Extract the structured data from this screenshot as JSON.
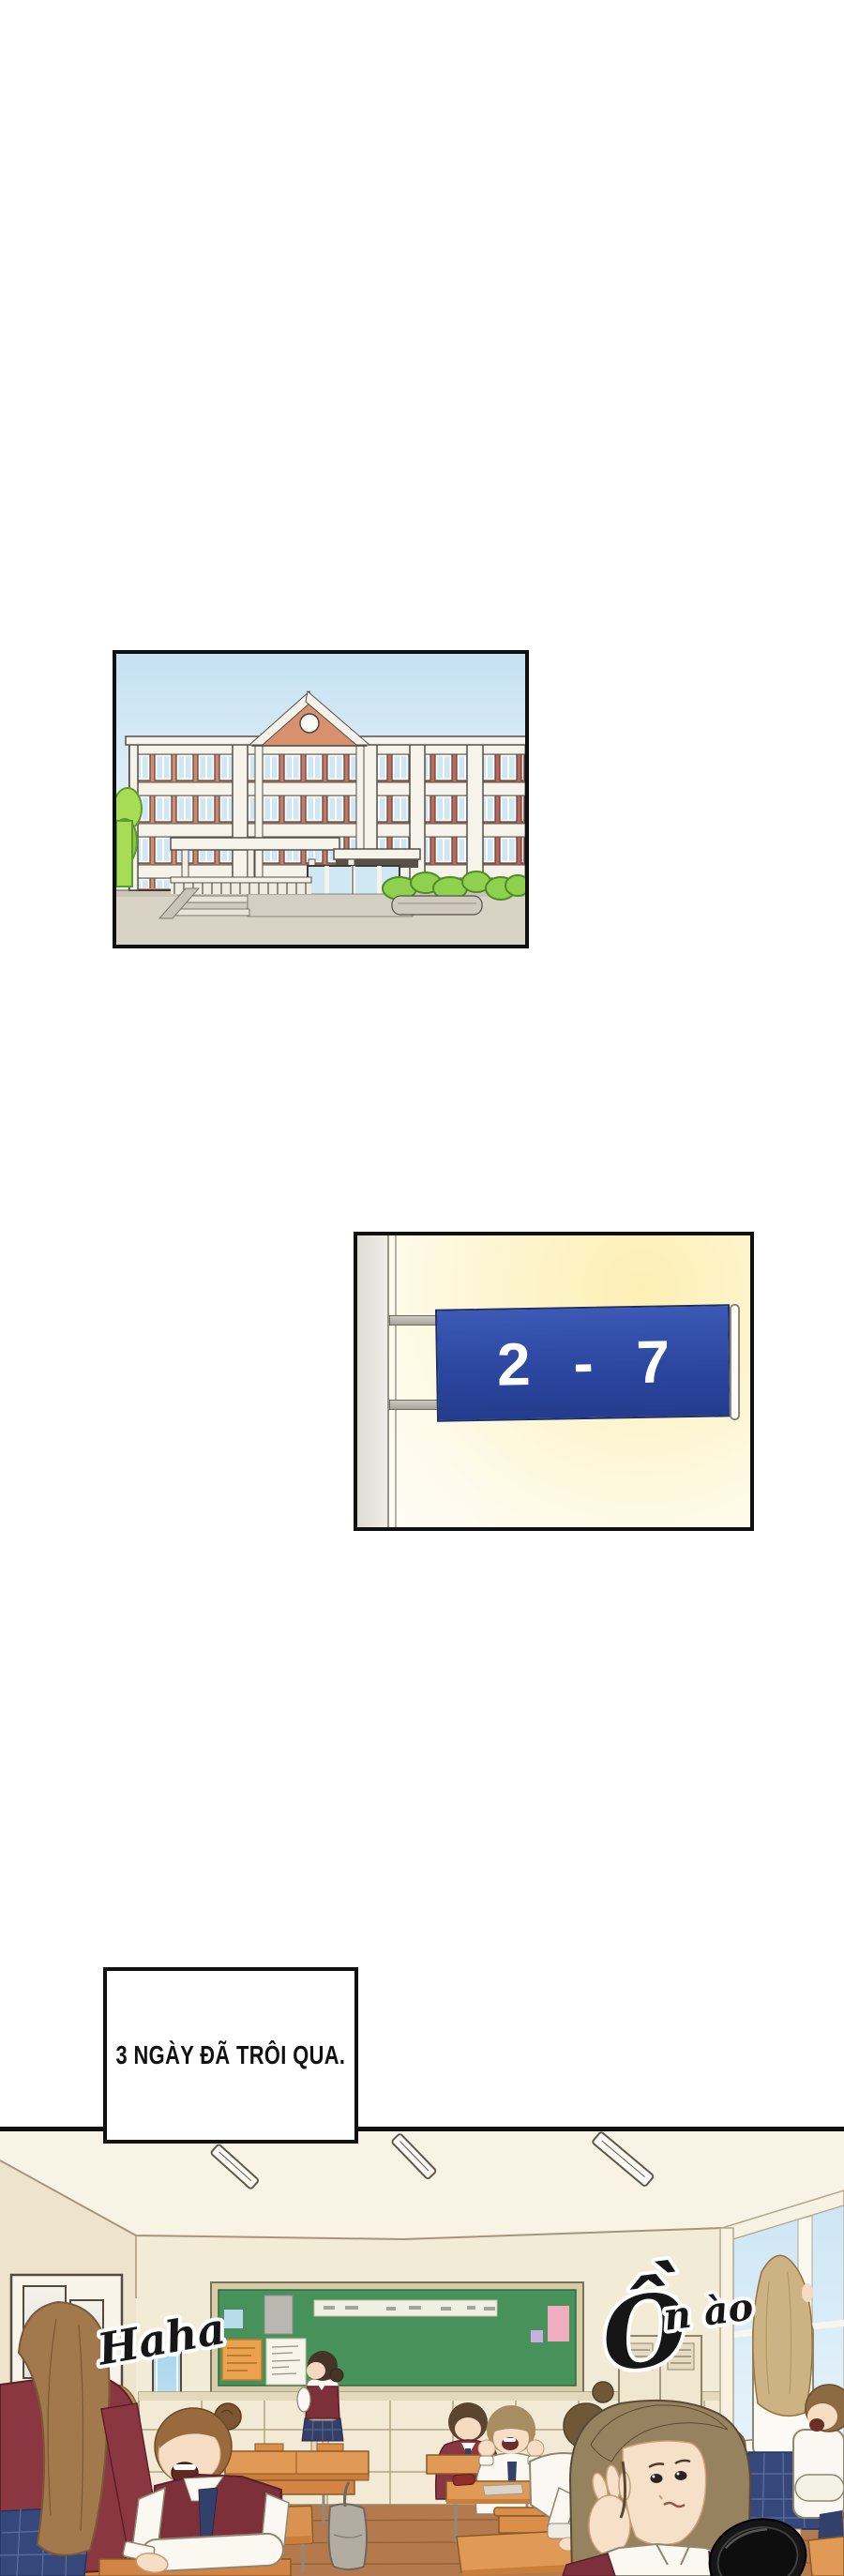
{
  "page": {
    "background_color": "#ffffff",
    "panel_border_color": "#101010"
  },
  "school_panel": {
    "brick_color": "#cc7263",
    "sky_color": "#c6e1f2",
    "bush_color": "#8fd14f",
    "trim_color": "#f6f3ea"
  },
  "room_sign_panel": {
    "sign_text": "2 - 7",
    "sign_plate_color": "#2b47a0",
    "sign_text_color": "#ffffff",
    "wall_background_color": "#fdf5d0"
  },
  "caption_panel": {
    "text": "3 NGÀY ĐÃ TRÔI QUA.",
    "text_color": "#111111",
    "background_color": "#ffffff"
  },
  "classroom_panel": {
    "sfx_haha": "Haha",
    "sfx_on_ao": {
      "initial": "Ồ",
      "rest": "n ào",
      "full": "Ồn ào"
    },
    "chalkboard_color": "#47915a",
    "uniform_vest_color": "#7d2f3a",
    "desk_wood_color": "#d9924f",
    "floor_wood_color": "#b5794e"
  }
}
